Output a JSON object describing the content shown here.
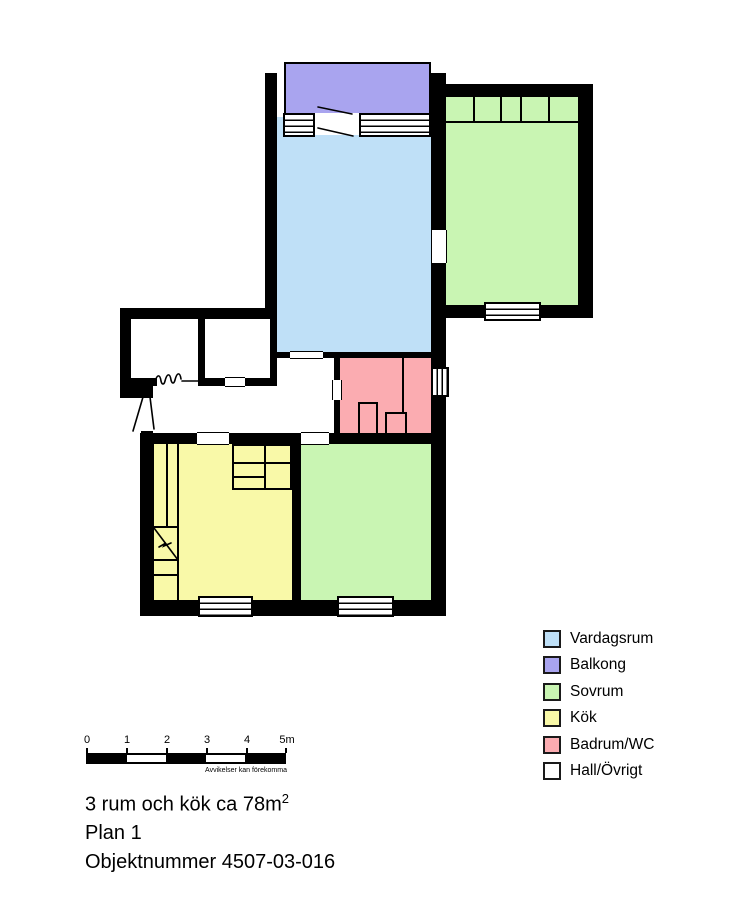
{
  "legend": {
    "items": [
      {
        "label": "Vardagsrum",
        "color": "#BFE0F7"
      },
      {
        "label": "Balkong",
        "color": "#A9A4EF"
      },
      {
        "label": "Sovrum",
        "color": "#C9F5B3"
      },
      {
        "label": "Kök",
        "color": "#F9F9A8"
      },
      {
        "label": "Badrum/WC",
        "color": "#FBACB1"
      },
      {
        "label": "Hall/Övrigt",
        "color": "#FFFFFF"
      }
    ]
  },
  "scalebar": {
    "ticks": [
      "0",
      "1",
      "2",
      "3",
      "4",
      "5m"
    ],
    "disclaimer": "Avvikelser kan förekomma"
  },
  "title": {
    "line1": "3 rum och kök ca 78m",
    "line1_sup": "2",
    "line2": "Plan 1",
    "line3": "Objektnummer 4507-03-016"
  },
  "colors": {
    "wall": "#000000",
    "background": "#FFFFFF"
  }
}
